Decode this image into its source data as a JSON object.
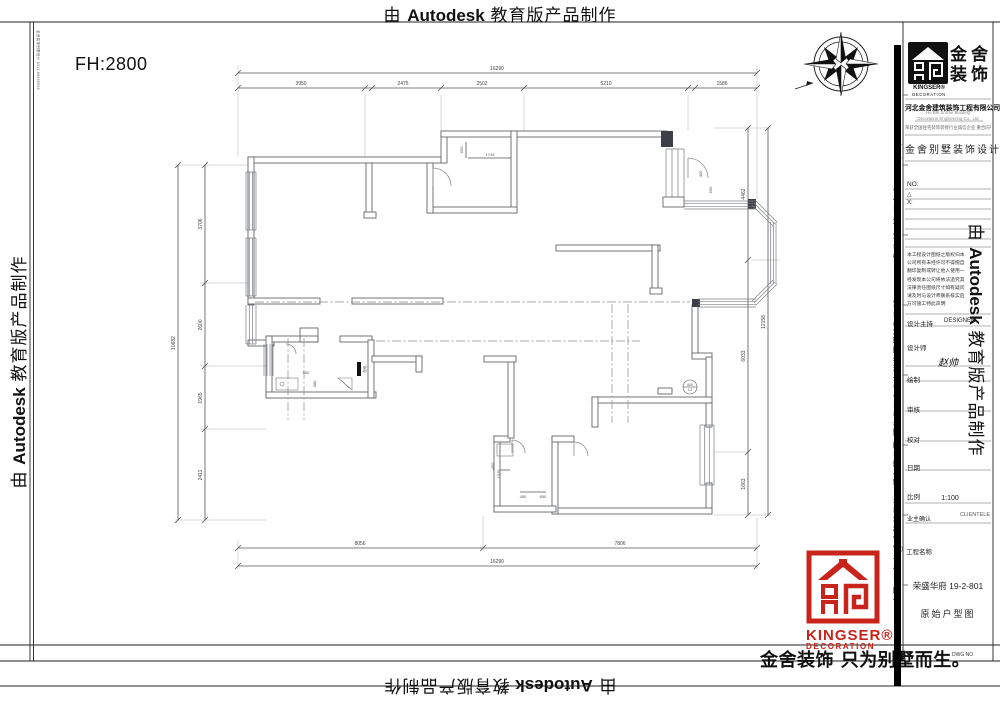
{
  "banner": {
    "pre": "由",
    "brand": "Autodesk",
    "post": "教育版产品制作"
  },
  "drawing": {
    "fh_label": "FH:2800",
    "micro_note": "金舍装饰别墅设计 0311-88995555",
    "dims": {
      "top_total": "16290",
      "top_s1": "3950",
      "top_s2": "2475",
      "top_s3": "2502",
      "top_s4": "5210",
      "top_s5": "1586",
      "bottom_s1": "8056",
      "bottom_s2": "7806",
      "bottom_total": "16290",
      "left_s1": "3706",
      "left_s2": "2600",
      "left_s3": "1965",
      "left_s4": "2411",
      "left_total": "10682",
      "right_s1": "4462",
      "right_s2": "6033",
      "right_s3": "1663",
      "right_total": "12158",
      "i1": "650",
      "i2": "1745",
      "i3": "450",
      "i4": "650",
      "i5": "550",
      "i6": "980",
      "i7": "1025",
      "i8": "450",
      "i9": "650",
      "i10": "450"
    },
    "labels": {
      "elec_box": "配电",
      "hydrant_1": "A05",
      "hydrant_2": "4-2"
    }
  },
  "titleblock": {
    "logo": {
      "cn_1": "金舍",
      "cn_2": "装饰",
      "en_1": "KINGSER®",
      "en_2": "DECORATION"
    },
    "company": {
      "name": "河北金舍建筑装饰工程有限公司",
      "en_1": "He Bei JinShe Building",
      "en_2": "Decoration Engineering Co., Ltd",
      "honor": "荣获全国住宅装饰装修行业诚信企业 重合同守信用单位"
    },
    "tagline": "金舍别墅装饰设计",
    "no_label": "NO.",
    "delta": "△",
    "x_label": "X:",
    "notes": [
      "本工程设计图纸之版权归本",
      "公司所有未经许可不得擅自",
      "翻印复制或转让他人使用一",
      "经发现本公司将依法追究其",
      "法律责任图纸尺寸如有疑问",
      "请及时与设计师联系核实后",
      "方可施工特此声明"
    ],
    "fields": {
      "design_director": "设计主持",
      "design_director_value": "DESIGNER",
      "designer": "设计师",
      "designer_value": "赵帅",
      "draw": "绘制",
      "review": "审核",
      "proof": "校对",
      "date": "日期",
      "scale": "比例",
      "scale_value": "1:100",
      "owner": "业主确认",
      "owner_value": "CLIENTELE",
      "registered": "®",
      "project": "工程名称",
      "project_value": "荣盛华府 19-2-801",
      "drawing_name": "原始户型图",
      "dwg_no": "DWG NO"
    },
    "side_text": "中国·石家庄 金舍建筑装饰工程有限公司 河北省石家庄市裕华区怀特陶瓷城411 506 陶瓷城6楼 石家庄 TEL (86) 0311-88995555",
    "red_logo": {
      "en_1": "KINGSER®",
      "en_2": "DECORATION"
    },
    "slogan": "金舍装饰 只为别墅而生。"
  }
}
